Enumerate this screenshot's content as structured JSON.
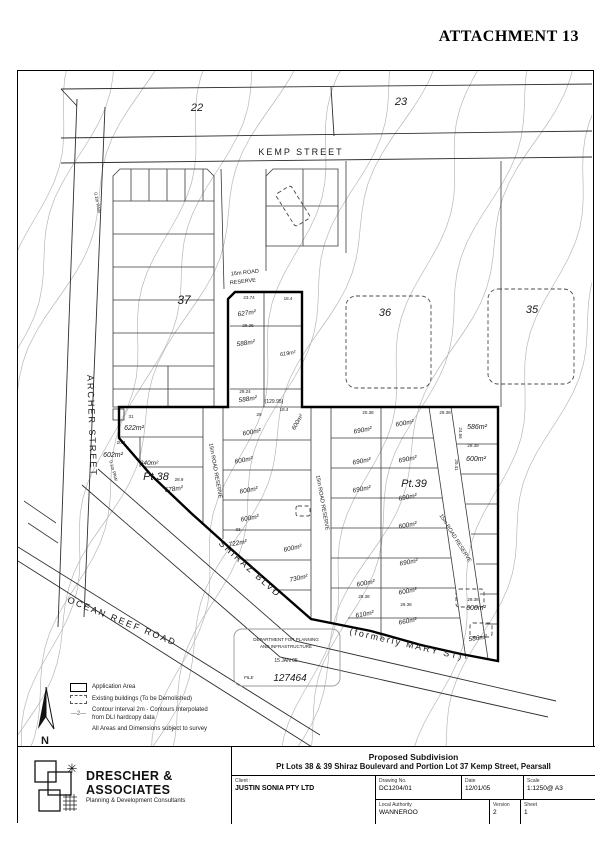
{
  "header": {
    "attachment": "ATTACHMENT 13"
  },
  "map": {
    "streets": [
      {
        "t": "KEMP STREET",
        "x": 283,
        "y": 84,
        "s": 9,
        "ls": 4
      },
      {
        "t": "ARCHER STREET",
        "x": 71,
        "y": 355,
        "s": 9,
        "ls": 3,
        "r": 88
      },
      {
        "t": "OCEAN REEF ROAD",
        "x": 103,
        "y": 553,
        "s": 9,
        "ls": 2,
        "r": 22
      },
      {
        "t": "SHIRAZ BLVD",
        "x": 230,
        "y": 500,
        "s": 9,
        "ls": 3,
        "r": 42
      },
      {
        "t": "(formerly MARY ST)",
        "x": 388,
        "y": 576,
        "s": 9,
        "ls": 1,
        "r": 13
      }
    ],
    "parcels": [
      {
        "t": "22",
        "x": 179,
        "y": 40,
        "s": 11
      },
      {
        "t": "23",
        "x": 383,
        "y": 34,
        "s": 11
      },
      {
        "t": "37",
        "x": 166,
        "y": 233,
        "s": 12
      },
      {
        "t": "36",
        "x": 367,
        "y": 245,
        "s": 11
      },
      {
        "t": "35",
        "x": 514,
        "y": 242,
        "s": 11
      },
      {
        "t": "Pt.38",
        "x": 138,
        "y": 409,
        "s": 11
      },
      {
        "t": "Pt.39",
        "x": 396,
        "y": 416,
        "s": 11
      }
    ],
    "reserves": [
      {
        "t": "16m ROAD",
        "x": 227,
        "y": 203,
        "s": 5.5,
        "r": -6
      },
      {
        "t": "RESERVE",
        "x": 225,
        "y": 212,
        "s": 5.5,
        "r": -6
      },
      {
        "t": "15m ROAD RESERVE",
        "x": 196,
        "y": 400,
        "s": 5.5,
        "r": 80
      },
      {
        "t": "15m ROAD RESERVE",
        "x": 303,
        "y": 432,
        "s": 5.5,
        "r": 80
      },
      {
        "t": "15m ROAD RESERVE",
        "x": 436,
        "y": 468,
        "s": 5.5,
        "r": 58
      },
      {
        "t": "0.1m PAW",
        "x": 78,
        "y": 132,
        "s": 4.5,
        "r": 80
      },
      {
        "t": "0.1m PAW",
        "x": 94,
        "y": 400,
        "s": 4.5,
        "r": 75
      },
      {
        "t": "(129.95)",
        "x": 256,
        "y": 332,
        "s": 5
      }
    ],
    "areas": [
      {
        "t": "627m²",
        "x": 229,
        "y": 244,
        "r": -8
      },
      {
        "t": "588m²",
        "x": 228,
        "y": 274,
        "r": -8
      },
      {
        "t": "619m²",
        "x": 270,
        "y": 284,
        "s": 5.5,
        "r": -8
      },
      {
        "t": "588m²",
        "x": 230,
        "y": 330,
        "r": -8
      },
      {
        "t": "622m²",
        "x": 116,
        "y": 359,
        "s": 7
      },
      {
        "t": "600m²",
        "x": 234,
        "y": 363,
        "r": -10
      },
      {
        "t": "600m²",
        "x": 281,
        "y": 352,
        "s": 6,
        "r": -60
      },
      {
        "t": "690m²",
        "x": 345,
        "y": 361,
        "r": -10
      },
      {
        "t": "600m²",
        "x": 387,
        "y": 354,
        "r": -10
      },
      {
        "t": "586m²",
        "x": 459,
        "y": 358,
        "s": 7
      },
      {
        "t": "602m²",
        "x": 95,
        "y": 386,
        "s": 7
      },
      {
        "t": "840m²",
        "x": 131,
        "y": 394
      },
      {
        "t": "600m²",
        "x": 226,
        "y": 391,
        "r": -10
      },
      {
        "t": "690m²",
        "x": 344,
        "y": 392,
        "r": -10
      },
      {
        "t": "690m²",
        "x": 390,
        "y": 390,
        "r": -10
      },
      {
        "t": "600m²",
        "x": 458,
        "y": 390,
        "s": 7
      },
      {
        "t": "678m²",
        "x": 156,
        "y": 420,
        "r": -8
      },
      {
        "t": "600m²",
        "x": 231,
        "y": 421,
        "r": -10
      },
      {
        "t": "690m²",
        "x": 344,
        "y": 420,
        "r": -10
      },
      {
        "t": "690m²",
        "x": 390,
        "y": 428,
        "r": -10
      },
      {
        "t": "600m²",
        "x": 232,
        "y": 449,
        "r": -10
      },
      {
        "t": "600m²",
        "x": 390,
        "y": 456,
        "r": -10
      },
      {
        "t": "722m²",
        "x": 220,
        "y": 474,
        "r": -10
      },
      {
        "t": "600m²",
        "x": 275,
        "y": 479,
        "r": -12
      },
      {
        "t": "690m²",
        "x": 391,
        "y": 493,
        "r": -10
      },
      {
        "t": "730m²",
        "x": 281,
        "y": 509,
        "r": -12
      },
      {
        "t": "600m²",
        "x": 348,
        "y": 514,
        "r": -10
      },
      {
        "t": "600m²",
        "x": 390,
        "y": 522,
        "r": -10
      },
      {
        "t": "600m²",
        "x": 458,
        "y": 539,
        "s": 7
      },
      {
        "t": "610m²",
        "x": 347,
        "y": 545,
        "r": -10
      },
      {
        "t": "660m²",
        "x": 390,
        "y": 552,
        "r": -10
      },
      {
        "t": "586m²",
        "x": 460,
        "y": 569,
        "r": -8
      }
    ],
    "dims": [
      {
        "t": "23.74",
        "x": 231,
        "y": 228
      },
      {
        "t": "18.4",
        "x": 270,
        "y": 229
      },
      {
        "t": "29.25",
        "x": 230,
        "y": 256
      },
      {
        "t": "29.24",
        "x": 227,
        "y": 322
      },
      {
        "t": "18.4",
        "x": 266,
        "y": 340
      },
      {
        "t": "31",
        "x": 113,
        "y": 347
      },
      {
        "t": "29",
        "x": 241,
        "y": 345
      },
      {
        "t": "20.38",
        "x": 350,
        "y": 343
      },
      {
        "t": "29.38",
        "x": 427,
        "y": 343
      },
      {
        "t": "29.39",
        "x": 455,
        "y": 376
      },
      {
        "t": "24.56",
        "x": 441,
        "y": 362,
        "r": 90
      },
      {
        "t": "20.41",
        "x": 437,
        "y": 394,
        "r": 90
      },
      {
        "t": "20.4",
        "x": 103,
        "y": 373
      },
      {
        "t": "28.9",
        "x": 161,
        "y": 410
      },
      {
        "t": "33",
        "x": 220,
        "y": 460
      },
      {
        "t": "29.38",
        "x": 346,
        "y": 527
      },
      {
        "t": "29.38",
        "x": 388,
        "y": 535
      },
      {
        "t": "29.38",
        "x": 455,
        "y": 530
      }
    ],
    "misc": [
      {
        "t": "N",
        "x": 27,
        "y": 673,
        "s": 11
      }
    ],
    "stamp": {
      "dept_line1": "DEPARTMENT FOR PLANNING",
      "dept_line2": "AND INFRASTRUCTURE",
      "date": "15 JAN 05",
      "file_label": "FILE",
      "file_number": "127464"
    }
  },
  "legend": {
    "application_area": "Application Area",
    "existing_buildings": "Existing buildings (To be Demolished)",
    "contour_symbol": "—2—",
    "contour_note_line1": "Contour Interval 2m - Contours Interpolated",
    "contour_note_line2": "from DLI  hardcopy data",
    "survey_note": "All Areas and Dimensions subject to survey"
  },
  "title_block": {
    "company": "DRESCHER & ASSOCIATES",
    "tagline": "Planning & Development Consultants",
    "project_title": "Proposed Subdivision",
    "project_subtitle": "Pt Lots 38 & 39 Shiraz Boulevard and Portion Lot 37 Kemp Street, Pearsall",
    "client_label": "Client :",
    "client_value": "JUSTIN SONIA PTY LTD",
    "drawing_no_label": "Drawing No.",
    "drawing_no_value": "DC1204/01",
    "date_label": "Date",
    "date_value": "12/01/05",
    "scale_label": "Scale",
    "scale_value": "1:1250@ A3",
    "authority_label": "Local Authority",
    "authority_value": "WANNEROO",
    "version_label": "Version",
    "version_value": "2",
    "sheet_label": "Sheet",
    "sheet_value": "1"
  }
}
